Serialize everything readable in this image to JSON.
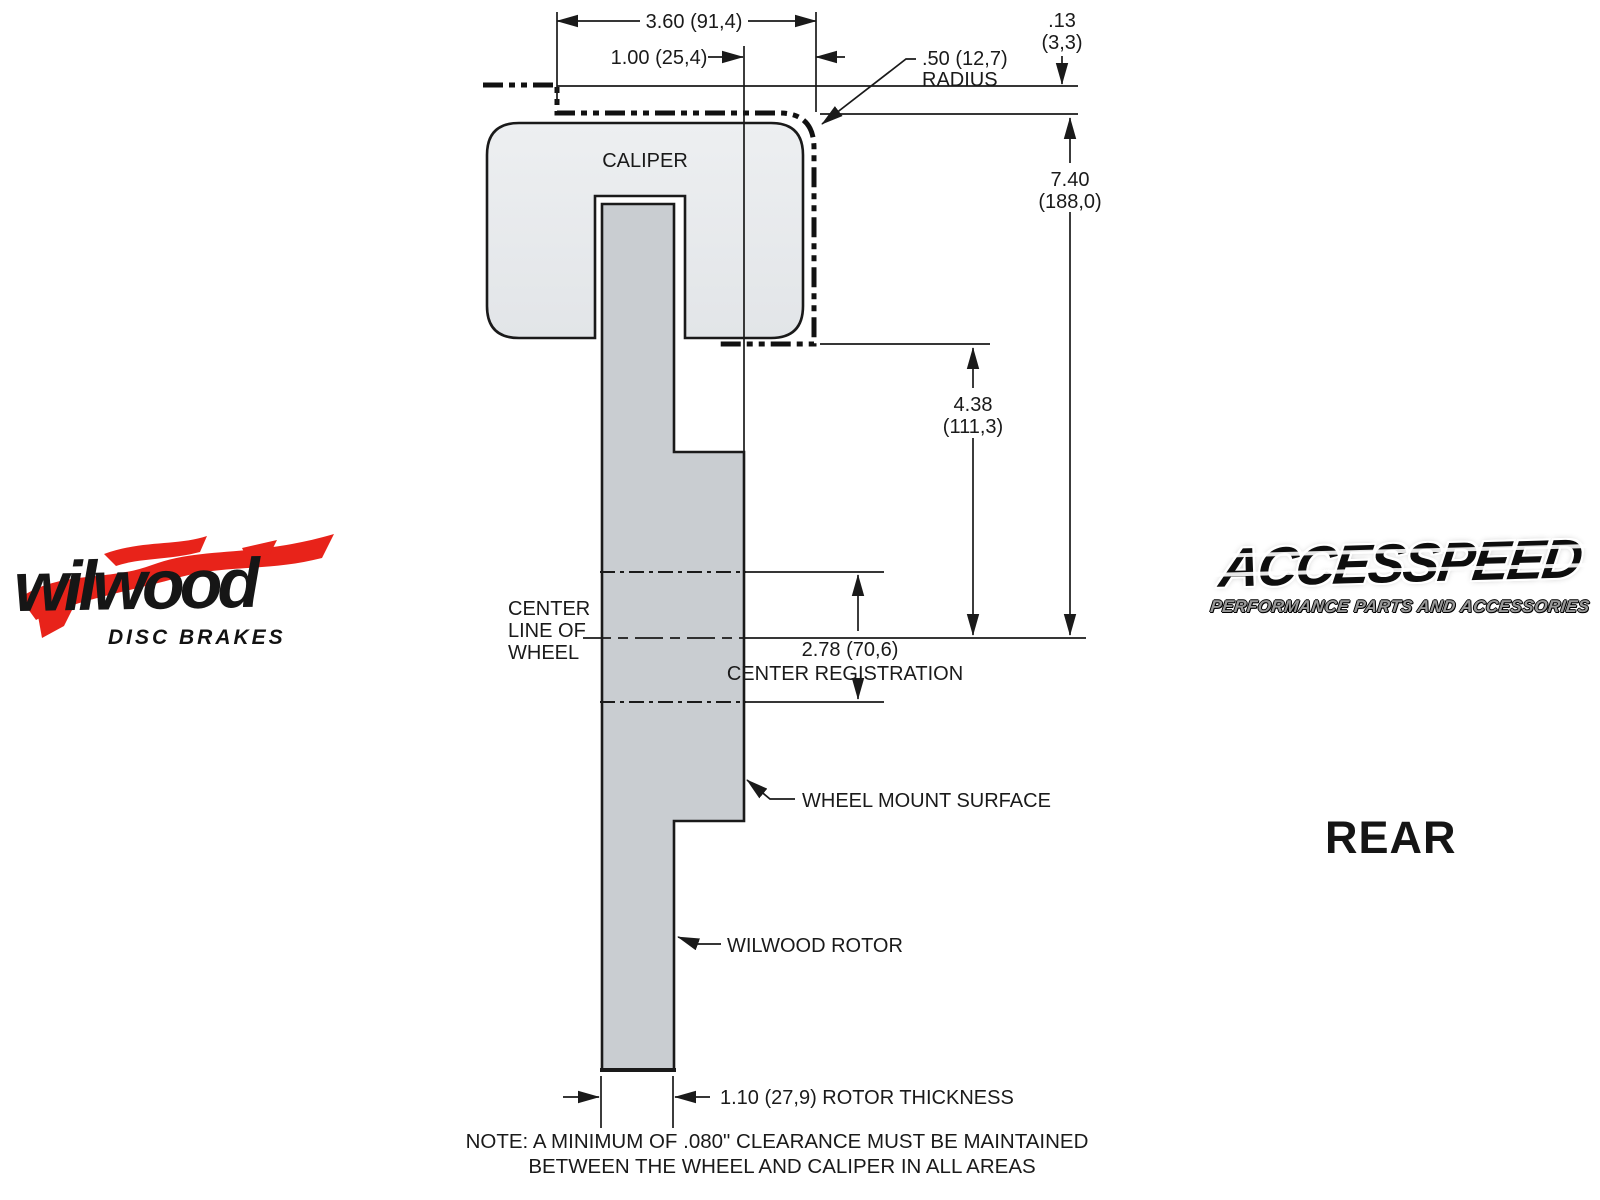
{
  "colors": {
    "line": "#1a1a1a",
    "caliper_fill_top": "#edeff1",
    "caliper_fill_bottom": "#e2e5e8",
    "rotor_fill": "#c9cdd1",
    "logo_red": "#e8231a",
    "background": "#ffffff"
  },
  "diagram": {
    "caliper_label": "CALIPER",
    "dim_width": "3.60 (91,4)",
    "dim_offset": "1.00 (25,4)",
    "dim_radius_line1": ".50 (12,7)",
    "dim_radius_line2": "RADIUS",
    "dim_clearance_line1": ".13",
    "dim_clearance_line2": "(3,3)",
    "dim_height_line1": "7.40",
    "dim_height_line2": "(188,0)",
    "dim_mount_height_line1": "4.38",
    "dim_mount_height_line2": "(111,3)",
    "dim_center_reg_line1": "2.78 (70,6)",
    "dim_center_reg_line2": "CENTER REGISTRATION",
    "dim_rotor_thickness": "1.10 (27,9) ROTOR THICKNESS",
    "label_centerline_line1": "CENTER",
    "label_centerline_line2": "LINE OF",
    "label_centerline_line3": "WHEEL",
    "label_wheel_mount": "WHEEL MOUNT SURFACE",
    "label_rotor": "WILWOOD ROTOR"
  },
  "note": {
    "line1": "NOTE: A MINIMUM OF .080\" CLEARANCE MUST BE MAINTAINED",
    "line2": "BETWEEN THE WHEEL AND CALIPER IN ALL AREAS"
  },
  "view_label": "REAR",
  "logos": {
    "wilwood_name": "wilwood",
    "wilwood_tagline": "DISC BRAKES",
    "accesspeed_name": "ACCESSPEED",
    "accesspeed_tagline": "PERFORMANCE PARTS AND ACCESSORIES"
  }
}
